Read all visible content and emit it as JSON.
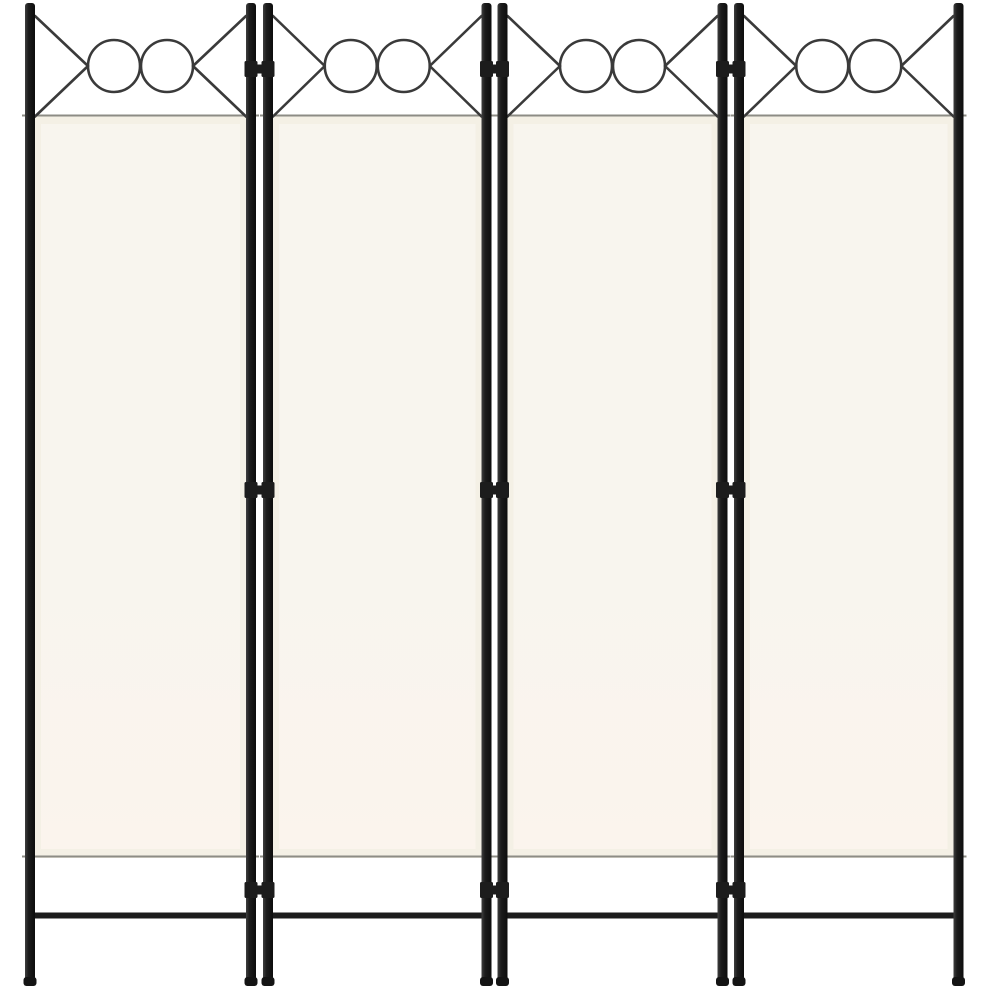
{
  "image": {
    "kind": "product-photo",
    "subject": "4-panel folding room divider screen, cream white fabric panels, black metal frame with decorative double-circle and crossed-wire top motif",
    "background_color": "#ffffff",
    "panel_count": 4,
    "colors": {
      "frame_dark": "#1c1c1c",
      "frame_highlight": "#3f3f3f",
      "frame_shadow": "#0d0d0d",
      "foot": "#141414",
      "wire": "#3a3a3a",
      "fabric_hem": "#f4f0e5",
      "fabric_top": "#f8f5ee",
      "fabric_bottom": "#fbf4ed",
      "rod_line": "#8d8c85"
    },
    "geometry": {
      "width": 992,
      "height": 992,
      "panels": [
        {
          "left": 30,
          "right": 251
        },
        {
          "left": 268,
          "right": 486.5
        },
        {
          "left": 502.5,
          "right": 722.5
        },
        {
          "left": 739,
          "right": 958.5
        }
      ],
      "pole": {
        "width": 10,
        "top": 3,
        "bottom": 985,
        "corner": 3
      },
      "foot": {
        "width": 13,
        "height": 9,
        "top": 977,
        "corner": 3
      },
      "deco": {
        "attach_top": 16,
        "attach_bottom": 116.5,
        "circle_cy": 66,
        "circle_r": 26,
        "circle_dx": 26.5,
        "stroke_width": 2.6
      },
      "fabric": {
        "top": 115,
        "bottom": 858,
        "inset": 3,
        "hem": 8
      },
      "rod": {
        "top_y": 115.5,
        "bottom_y": 856.5,
        "overhang": 8,
        "thickness": 2
      },
      "hinges": {
        "ys": [
          69,
          490,
          890
        ],
        "sleeve_w": 13,
        "sleeve_h": 16,
        "bar_h": 9,
        "bar_overhang": 2
      },
      "bottom_bar": {
        "y": 915.5,
        "thickness": 6
      }
    }
  }
}
